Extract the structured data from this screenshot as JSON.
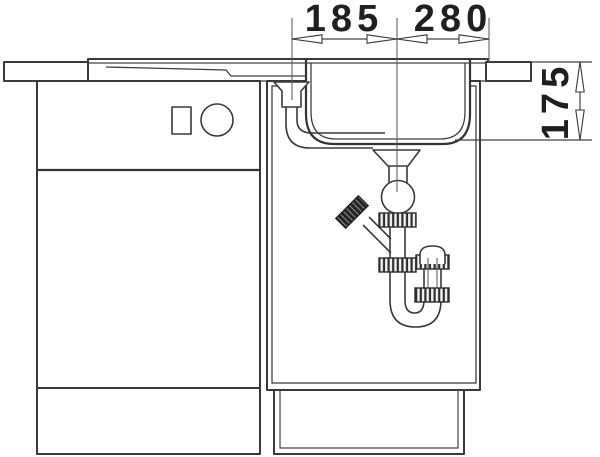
{
  "diagram": {
    "type": "technical-drawing",
    "subject": "kitchen-sink-side-section-with-base-cabinets-and-trap",
    "dimensions": {
      "drainboard_width": "185",
      "bowl_width": "280",
      "bowl_depth": "175"
    },
    "colors": {
      "line": "#3a3a3a",
      "text": "#1f1f1f",
      "background": "#ffffff",
      "dark_fitting": "#222222"
    }
  }
}
